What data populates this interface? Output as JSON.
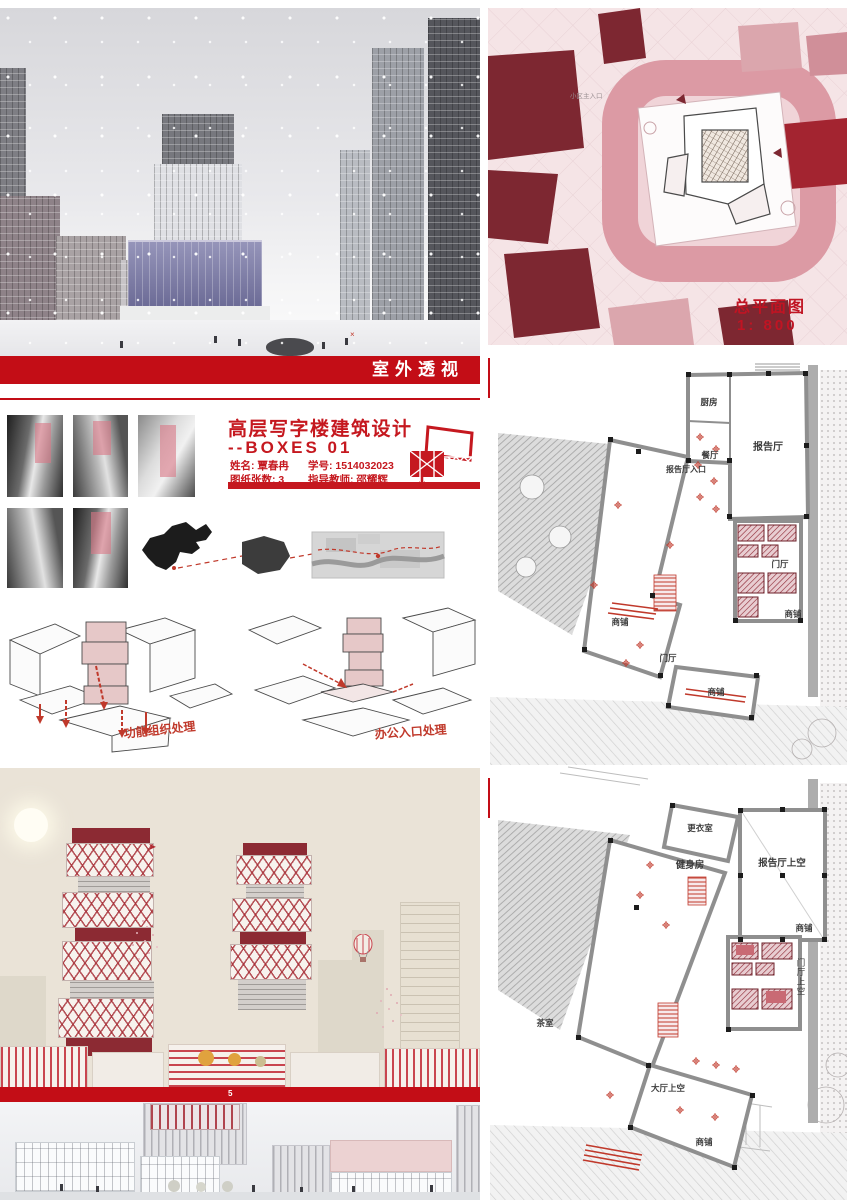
{
  "board": {
    "perspective_caption": "室外透视",
    "site_plan": {
      "title_line1": "总平面图",
      "title_line2": "1: 800",
      "entrance_label": "小区主入口"
    },
    "title_block": {
      "title_line1": "高层写字楼建筑设计",
      "title_line2": "--BOXES  01",
      "name": "姓名: 覃春冉",
      "student_id": "学号: 1514032023",
      "sheet_count": "图纸张数: 3",
      "advisor": "指导教师: 邵耀辉"
    },
    "diagrams": {
      "left_caption": "功能组织处理",
      "right_caption": "办公入口处理"
    },
    "plan1": {
      "title_line1": "一层平面图",
      "title_line2": "1: 400",
      "rooms": {
        "kitchen": "厨房",
        "lecture_hall": "报告厅",
        "dining": "餐厅",
        "lecture_entrance": "报告厅入口",
        "lobby_core": "门厅",
        "shop_left": "商铺",
        "lobby_center": "门厅",
        "shop_bottom": "商铺",
        "shop_right": "商铺"
      }
    },
    "plan2": {
      "title_line1": "二层平面图",
      "title_line2": "1: 400",
      "rooms": {
        "changing_room": "更衣室",
        "gym": "健身房",
        "lecture_void": "报告厅上空",
        "shop_right": "商铺",
        "lobby_void": "门厅上空",
        "tea_room": "茶室",
        "hall_void": "大厅上空",
        "shop_bottom": "商铺"
      }
    },
    "section_band_number": "5"
  }
}
